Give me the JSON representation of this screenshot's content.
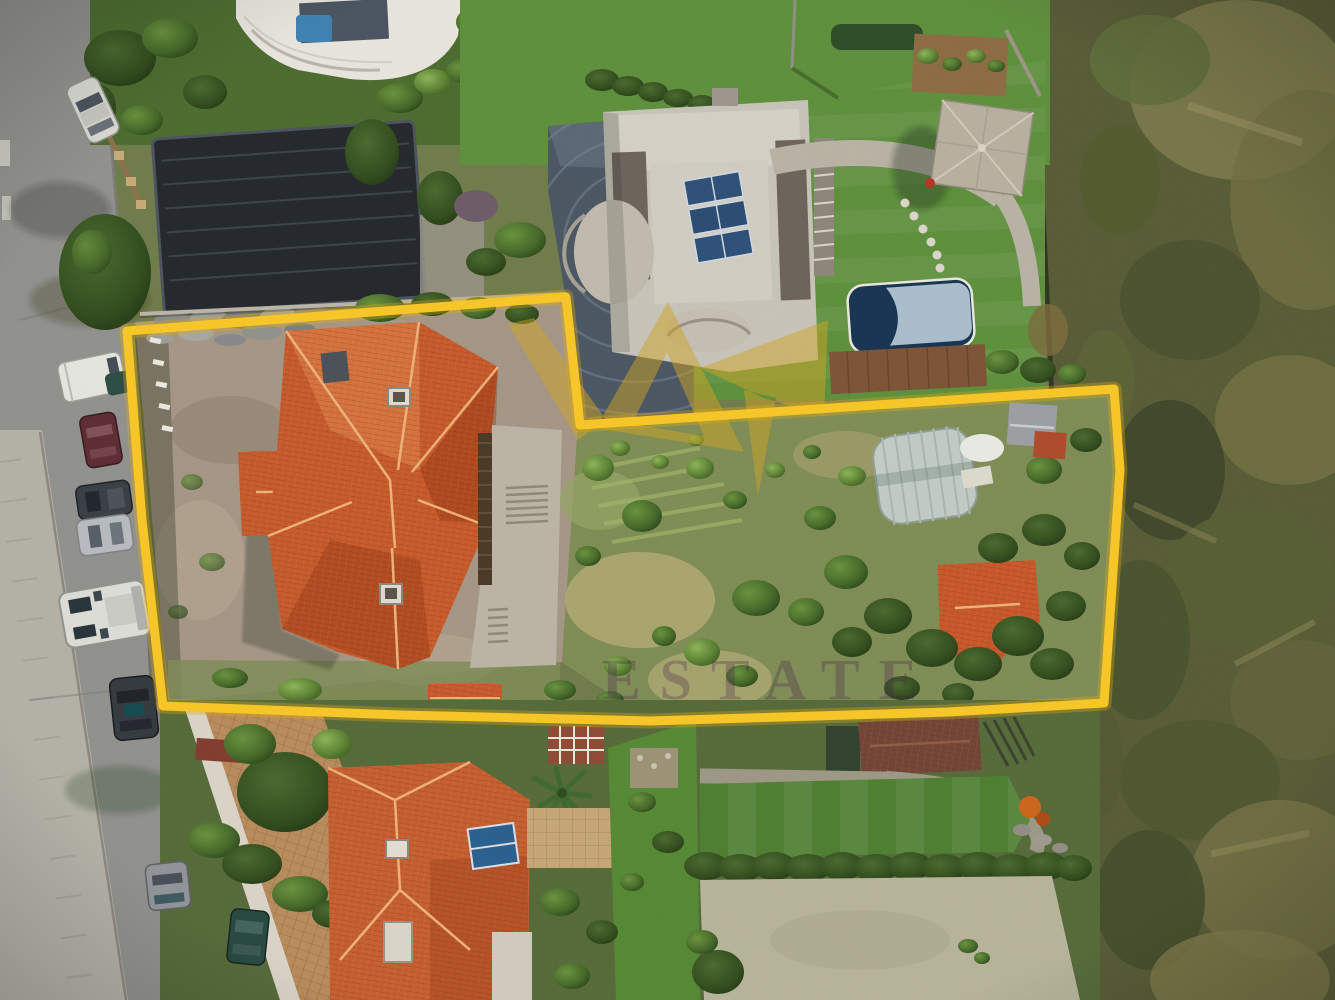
{
  "meta": {
    "kind": "aerial-drone-photograph",
    "subject": "Top-down drone photo of a residential land plot outlined with a yellow boundary, flanked by a street with parked cars (left), a modern villa with pool and gazebo (top), a house with terracotta roof (bottom) and wild scrubland (right)."
  },
  "boundary": {
    "points": "127,331 566,297 580,425 1114,389 1120,470 1104,703 948,712 650,721 400,715 163,706 142,520",
    "color": "#F3C52E",
    "halo_color": "rgba(222,168,24,0.35)",
    "line_width": "9"
  },
  "watermark": {
    "text": "ESTATE",
    "text_color": "rgba(70,35,72,0.30)",
    "logo_color": "#C9A227",
    "logo_opacity": "0.5"
  },
  "palette": {
    "road": "#8F8F8B",
    "sidewalk": "#B2AFA6",
    "dirt": "#A39584",
    "lawn": "#5E8D3E",
    "lawn_dark": "#4E7C33",
    "garden": "#7D8A56",
    "scrub": "#565A36",
    "roof_main": "#C05A2C",
    "roof_south": "#BF5E31",
    "roof_garage": "#6E4436",
    "villa_concrete": "#C6C2B8",
    "pool_water": "#16324E",
    "pool_cover": "#A9BCC9",
    "pool_deck": "#7A5236",
    "greenhouse": "#C9D2D4",
    "driveway_pavers": "#4A5560",
    "paver_drive_tan": "#B48A5E",
    "carport": "#23272B"
  },
  "regions": {
    "street": "asphalt street with parked vehicles",
    "subject_plot": "L-shaped parcel with terracotta-roof house, overgrown garden, greenhouse",
    "neighbor_north": "concrete villa, solar panels, lawn, gazebo, covered pool",
    "neighbor_south": "terracotta-roof house with solar water heater",
    "east": "undeveloped scrubland behind fence"
  }
}
